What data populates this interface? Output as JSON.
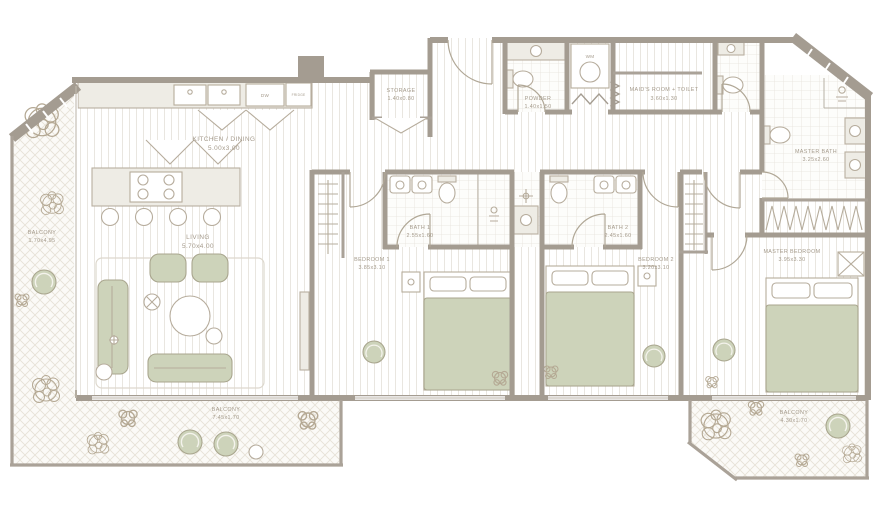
{
  "plan_title": "apartment-floor-plan",
  "colors": {
    "wall": "#a49c91",
    "sage": "#cdd3ba",
    "label_text": "#a49a8b",
    "floor_line": "#e9e6e0"
  },
  "rooms": {
    "kitchen": {
      "name": "KITCHEN / DINING",
      "dims": "5.00x3.00"
    },
    "living": {
      "name": "LIVING",
      "dims": "5.70x4.00"
    },
    "storage": {
      "name": "STORAGE",
      "dims": "1.40x0.80"
    },
    "powder": {
      "name": "POWDER",
      "dims": "1.40x1.50"
    },
    "maids": {
      "name": "MAID'S ROOM + TOILET",
      "dims": "3.60x1.30"
    },
    "masterBath": {
      "name": "MASTER BATH",
      "dims": "3.25x2.60"
    },
    "bath1": {
      "name": "BATH 1",
      "dims": "2.55x1.60"
    },
    "bath2": {
      "name": "BATH 2",
      "dims": "2.45x1.60"
    },
    "bedroom1": {
      "name": "BEDROOM 1",
      "dims": "3.85x3.10"
    },
    "bedroom2": {
      "name": "BEDROOM 2",
      "dims": "3.20x3.10"
    },
    "master": {
      "name": "MASTER BEDROOM",
      "dims": "3.95x3.30"
    },
    "balconyLeft": {
      "name": "BALCONY",
      "dims": "1.70x4.95"
    },
    "balconyBottom": {
      "name": "BALCONY",
      "dims": "7.45x1.70"
    },
    "balconyRight": {
      "name": "BALCONY",
      "dims": "4.30x1.70"
    }
  },
  "appliances": {
    "dishwasher": "DW",
    "washer": "WM",
    "fridge": "FRIDGE"
  }
}
